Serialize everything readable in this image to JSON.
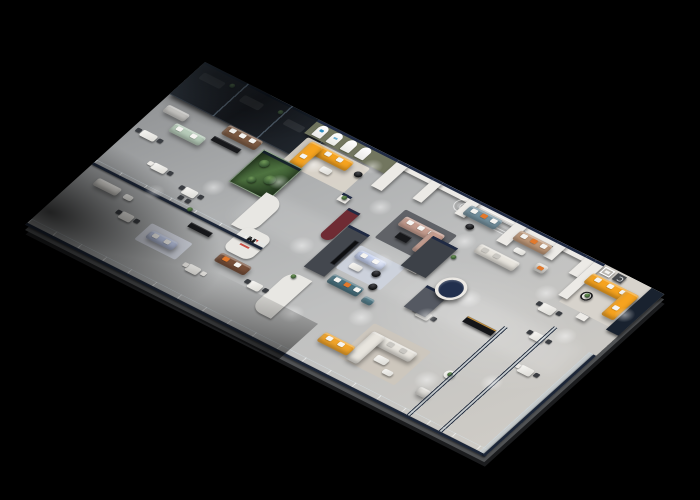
{
  "scene": {
    "title": "Isometric 3D cutaway floor plan of a furniture showroom",
    "background": "#000000",
    "style": "photorealistic render on black backdrop, walls cut with navy caps, glass balustrades"
  },
  "regions": {
    "offices": "dark-glass-offices",
    "west": "west-showroom-desks-and-sofas",
    "arch": "arched-brand-display-room",
    "terrarium": "glass-terrarium-display",
    "center": "central-lounge-displays",
    "media": "media-feature-wall-lounge",
    "front": "front-glass-balustrade",
    "east": "east-showroom-lounges",
    "gallery": "orange-gallery-lounge"
  },
  "palette": {
    "background": "#000000",
    "floor": "#b4b6b7",
    "floor_light": "#d7d3cc",
    "wall_face": "#eceae6",
    "wall_cap_navy": "#1f2a44",
    "outer_wall_navy": "#19222f",
    "dark_glass": "#14171c",
    "glass_tint": "#a5b9c8",
    "accent_orange": "#f6a31f",
    "accent_amber": "#f1a42a",
    "sofa_teal": "#4a7381",
    "ottoman_teal": "#56808e",
    "sofa_blush": "#c69d8f",
    "sofa_sage": "#b6cbb9",
    "sofa_lightblue": "#c2cdec",
    "sofa_lightblue2": "#c3cfee",
    "sofa_brown": "#7e5c44",
    "sofa_leather": "#774f39",
    "sofa_tan": "#bf9878",
    "sofa_steelblue": "#74919f",
    "sofa_cream": "#e8e5de",
    "sofa_gray": "#c7c6c3",
    "sofa_white": "#e3e1dc",
    "wall_olive": "#72765f",
    "wall_maroon": "#6f2b33",
    "wall_charcoal": "#43474e",
    "wall_charcoal_dark": "#3d4148",
    "wall_slate": "#555962",
    "terrarium_green": "#4e7340",
    "rug_dark": "#56595e",
    "rug_beige": "#cdc7bc",
    "rug_ivory": "#ddd6cb",
    "rug_bluegray": "#d9dde8",
    "rug_lounge": "#cdd3de",
    "logo_black": "#161616",
    "logo_red": "#c23128",
    "arch_logo_blue": "#2e8fc0",
    "gold_trim": "#b98a3e"
  }
}
